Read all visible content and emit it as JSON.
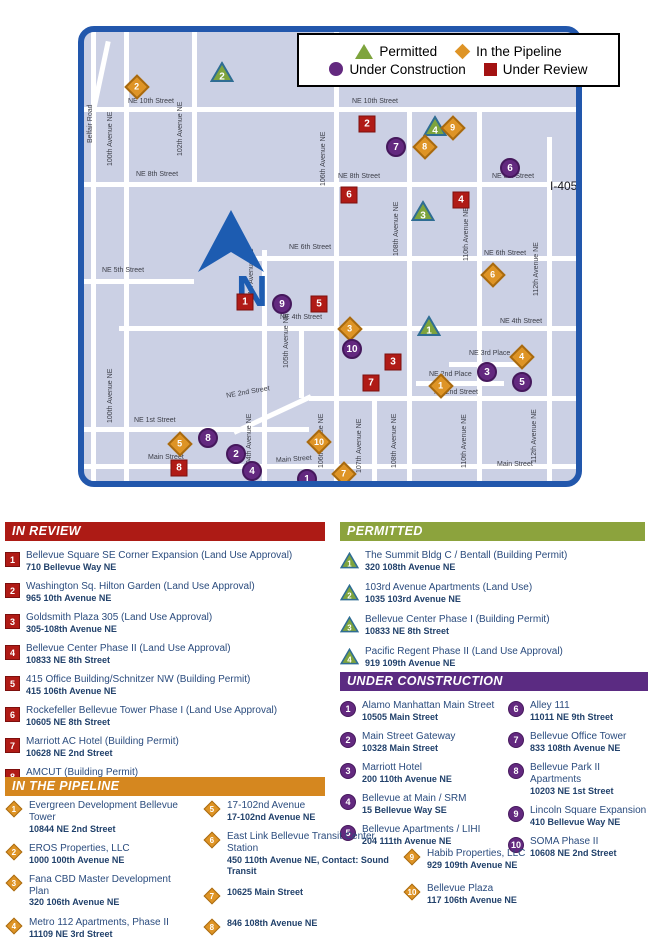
{
  "legend": {
    "items": [
      {
        "label": "Permitted"
      },
      {
        "label": "In the Pipeline"
      },
      {
        "label": "Under Construction"
      },
      {
        "label": "Under Review"
      }
    ]
  },
  "map": {
    "compass_letter": "N",
    "street_labels": [
      "NE 10th Street",
      "NE 10th Street",
      "Belfair Road",
      "100th Avenue NE",
      "102th Avenue NE",
      "NE 8th Street",
      "NE 8th Street",
      "NE 8th Street",
      "I-405",
      "106th Avenue NE",
      "108th Avenue NE",
      "110th Avenue NE",
      "112th Avenue NE",
      "99th Avenue NE",
      "NE 6th Street",
      "NE 6th Street",
      "NE 5th Street",
      "104th Avenue NE",
      "NE 4th Street",
      "NE 4th Street",
      "105th Avenue NE",
      "NE 3rd Place",
      "NE 2nd Place",
      "NE 2nd Street",
      "NE 2nd Street",
      "NE 1st Street",
      "104th Avenue NE",
      "106th Avenue NE",
      "107th Avenue NE",
      "108th Avenue NE",
      "110th Avenue NE",
      "112th Avenue NE",
      "Main Street",
      "Main Street",
      "Main Street",
      "100th Avenue NE"
    ],
    "markers": [
      {
        "type": "pipeline",
        "label": "2"
      },
      {
        "type": "permitted",
        "label": "2"
      },
      {
        "type": "review",
        "label": "2"
      },
      {
        "type": "permitted",
        "label": "4"
      },
      {
        "type": "pipeline",
        "label": "9"
      },
      {
        "type": "pipeline",
        "label": "8"
      },
      {
        "type": "construction",
        "label": "7"
      },
      {
        "type": "construction",
        "label": "6"
      },
      {
        "type": "review",
        "label": "6"
      },
      {
        "type": "review",
        "label": "4"
      },
      {
        "type": "permitted",
        "label": "3"
      },
      {
        "type": "pipeline",
        "label": "6"
      },
      {
        "type": "review",
        "label": "1"
      },
      {
        "type": "construction",
        "label": "9"
      },
      {
        "type": "review",
        "label": "5"
      },
      {
        "type": "permitted",
        "label": "1"
      },
      {
        "type": "pipeline",
        "label": "3"
      },
      {
        "type": "construction",
        "label": "10"
      },
      {
        "type": "review",
        "label": "3"
      },
      {
        "type": "pipeline",
        "label": "4"
      },
      {
        "type": "construction",
        "label": "3"
      },
      {
        "type": "construction",
        "label": "5"
      },
      {
        "type": "review",
        "label": "7"
      },
      {
        "type": "pipeline",
        "label": "1"
      },
      {
        "type": "construction",
        "label": "8"
      },
      {
        "type": "pipeline",
        "label": "10"
      },
      {
        "type": "pipeline",
        "label": "5"
      },
      {
        "type": "construction",
        "label": "2"
      },
      {
        "type": "review",
        "label": "8"
      },
      {
        "type": "construction",
        "label": "4"
      },
      {
        "type": "construction",
        "label": "1"
      },
      {
        "type": "pipeline",
        "label": "7"
      }
    ]
  },
  "sections": {
    "in_review": {
      "header": "IN REVIEW",
      "items": [
        {
          "num": "1",
          "title": "Bellevue Square SE Corner Expansion (Land Use Approval)",
          "address": "710 Bellevue Way NE"
        },
        {
          "num": "2",
          "title": "Washington Sq. Hilton Garden (Land Use Approval)",
          "address": "965 10th Avenue NE"
        },
        {
          "num": "3",
          "title": "Goldsmith Plaza 305 (Land Use Approval)",
          "address": "305-108th Avenue NE"
        },
        {
          "num": "4",
          "title": "Bellevue Center Phase II (Land Use Approval)",
          "address": "10833 NE 8th Street"
        },
        {
          "num": "5",
          "title": "415 Office Building/Schnitzer NW (Building Permit)",
          "address": "415 106th Avenue NE"
        },
        {
          "num": "6",
          "title": "Rockefeller Bellevue Tower Phase I (Land Use Approval)",
          "address": "10605 NE 8th Street"
        },
        {
          "num": "7",
          "title": "Marriott AC Hotel (Building Permit)",
          "address": "10628 NE 2nd Street"
        },
        {
          "num": "8",
          "title": "AMCUT (Building Permit)",
          "address": "10133 Main Street"
        }
      ]
    },
    "permitted": {
      "header": "PERMITTED",
      "items": [
        {
          "num": "1",
          "title": "The Summit Bldg C / Bentall (Building Permit)",
          "address": "320 108th Avenue NE"
        },
        {
          "num": "2",
          "title": "103rd Avenue Apartments (Land Use)",
          "address": "1035 103rd Avenue NE"
        },
        {
          "num": "3",
          "title": "Bellevue Center Phase I (Building Permit)",
          "address": "10833 NE 8th Street"
        },
        {
          "num": "4",
          "title": "Pacific Regent Phase II (Land Use Approval)",
          "address": "919 109th Avenue NE"
        }
      ]
    },
    "under_construction": {
      "header": "UNDER CONSTRUCTION",
      "items": [
        {
          "num": "1",
          "title": "Alamo Manhattan Main Street",
          "address": "10505 Main Street"
        },
        {
          "num": "2",
          "title": "Main Street Gateway",
          "address": "10328 Main Street"
        },
        {
          "num": "3",
          "title": "Marriott Hotel",
          "address": "200 110th Avenue NE"
        },
        {
          "num": "4",
          "title": "Bellevue at Main / SRM",
          "address": "15 Bellevue Way SE"
        },
        {
          "num": "5",
          "title": "Bellevue Apartments / LIHI",
          "address": "204 111th Avenue NE"
        },
        {
          "num": "6",
          "title": "Alley 111",
          "address": "11011 NE 9th Street"
        },
        {
          "num": "7",
          "title": "Bellevue Office Tower",
          "address": "833 108th Avenue NE"
        },
        {
          "num": "8",
          "title": "Bellevue Park II Apartments",
          "address": "10203 NE 1st Street"
        },
        {
          "num": "9",
          "title": "Lincoln Square Expansion",
          "address": "410 Bellevue Way NE"
        },
        {
          "num": "10",
          "title": "SOMA Phase II",
          "address": "10608 NE 2nd Street"
        }
      ]
    },
    "pipeline": {
      "header": "IN THE PIPELINE",
      "items": [
        {
          "num": "1",
          "title": "Evergreen Development Bellevue Tower",
          "address": "10844 NE 2nd Street"
        },
        {
          "num": "2",
          "title": "EROS Properties, LLC",
          "address": "1000 100th Avenue NE"
        },
        {
          "num": "3",
          "title": "Fana CBD Master Development Plan",
          "address": "320 106th Avenue NE"
        },
        {
          "num": "4",
          "title": "Metro 112 Apartments, Phase II",
          "address": "11109 NE 3rd Street"
        },
        {
          "num": "5",
          "title": "17-102nd Avenue",
          "address": "17-102nd Avenue NE"
        },
        {
          "num": "6",
          "title": "East Link Bellevue Transit Center Station",
          "address": "450 110th Avenue NE, Contact: Sound Transit"
        },
        {
          "num": "7",
          "title": "",
          "address": "10625 Main Street"
        },
        {
          "num": "8",
          "title": "",
          "address": "846 108th Avenue NE"
        },
        {
          "num": "9",
          "title": "Habib Properties, LLC",
          "address": "929 109th Avenue NE"
        },
        {
          "num": "10",
          "title": "Bellevue Plaza",
          "address": "117 106th Avenue NE"
        }
      ]
    }
  }
}
